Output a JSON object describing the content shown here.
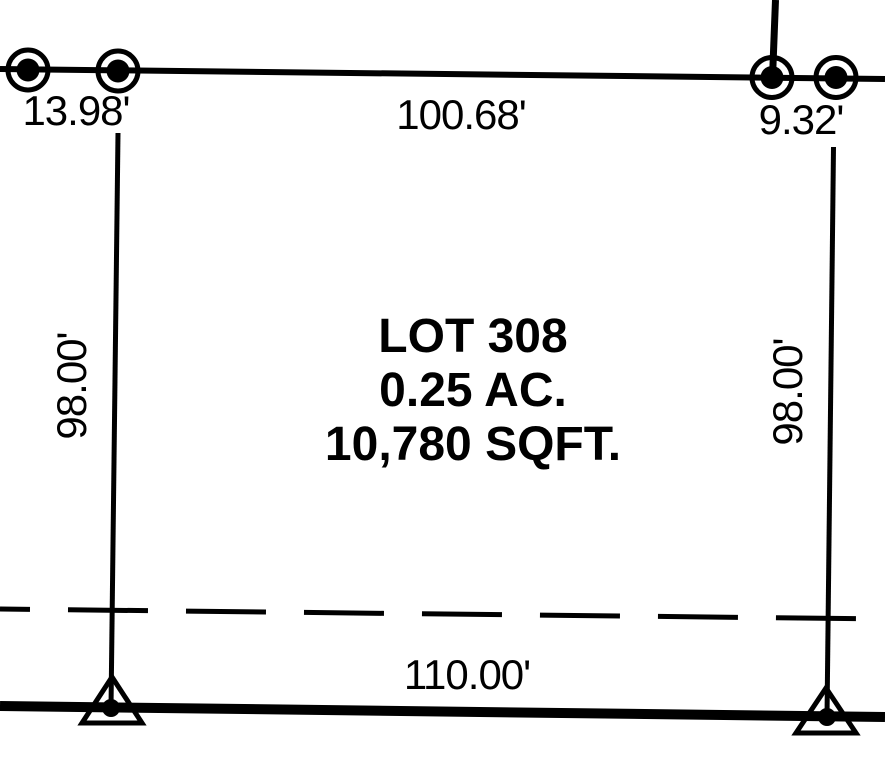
{
  "drawing": {
    "type": "survey-plat",
    "background_color": "#ffffff",
    "line_color": "#000000",
    "lot": {
      "name": "LOT 308",
      "acreage": "0.25 AC.",
      "square_feet": "10,780 SQFT."
    },
    "dimensions": {
      "top_left_offset": "13.98'",
      "top_frontage": "100.68'",
      "top_right_offset": "9.32'",
      "left_depth": "98.00'",
      "right_depth": "98.00'",
      "bottom_width": "110.00'"
    },
    "symbols": {
      "found_monument": "circle-with-dot",
      "control_point": "triangle-with-dot"
    }
  }
}
